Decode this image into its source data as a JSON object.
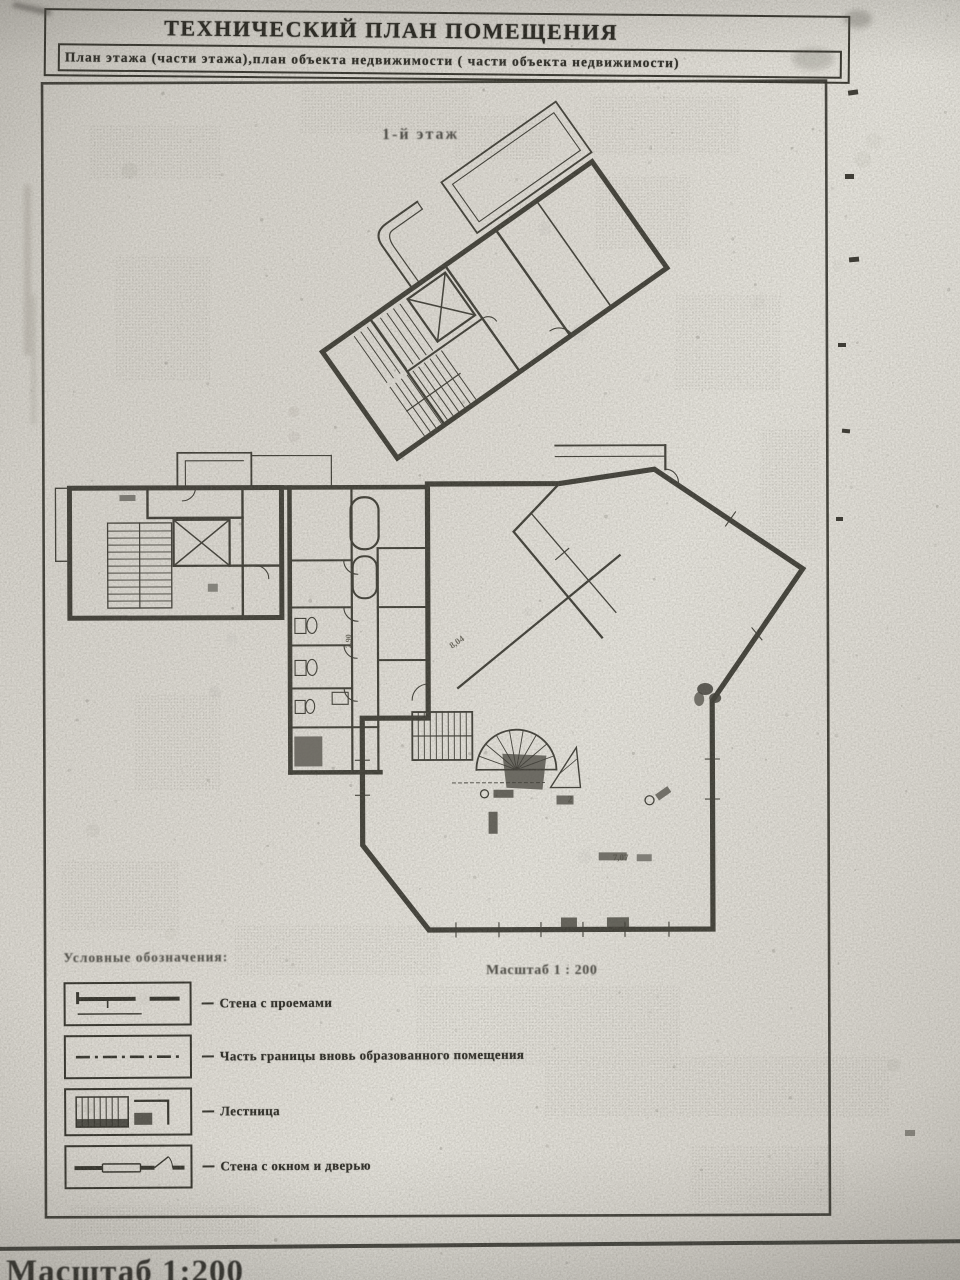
{
  "document": {
    "title": "ТЕХНИЧЕСКИЙ ПЛАН ПОМЕЩЕНИЯ",
    "subtitle": "План этажа (части этажа),план объекта недвижимости  ( части объекта недвижимости)",
    "floor_label": "1-й этаж",
    "scale_label": "Масштаб 1 : 200",
    "footer_fragment": "Масштаб 1:200"
  },
  "legend": {
    "heading": "Условные обозначения:",
    "items": [
      {
        "symbol": "wall-with-openings-icon",
        "label": "Стена с проемами"
      },
      {
        "symbol": "formed-boundary-icon",
        "label": "Часть границы вновь образованного помещения"
      },
      {
        "symbol": "stairs-icon",
        "label": "Лестница"
      },
      {
        "symbol": "wall-window-door-icon",
        "label": "Стена с окном и дверью"
      }
    ]
  },
  "plan": {
    "annotations": [
      {
        "text": "8,04",
        "x": 452,
        "y": 649,
        "rot": -35,
        "size": 9
      },
      {
        "text": "7,07",
        "x": 612,
        "y": 861,
        "rot": 0,
        "size": 9
      },
      {
        "text": "2",
        "x": 567,
        "y": 803,
        "rot": 0,
        "size": 10
      },
      {
        "text": "2,90",
        "x": 351,
        "y": 648,
        "rot": -90,
        "size": 8
      }
    ]
  },
  "colors": {
    "ink": "#34332c",
    "paper": "#d9d6cf"
  }
}
